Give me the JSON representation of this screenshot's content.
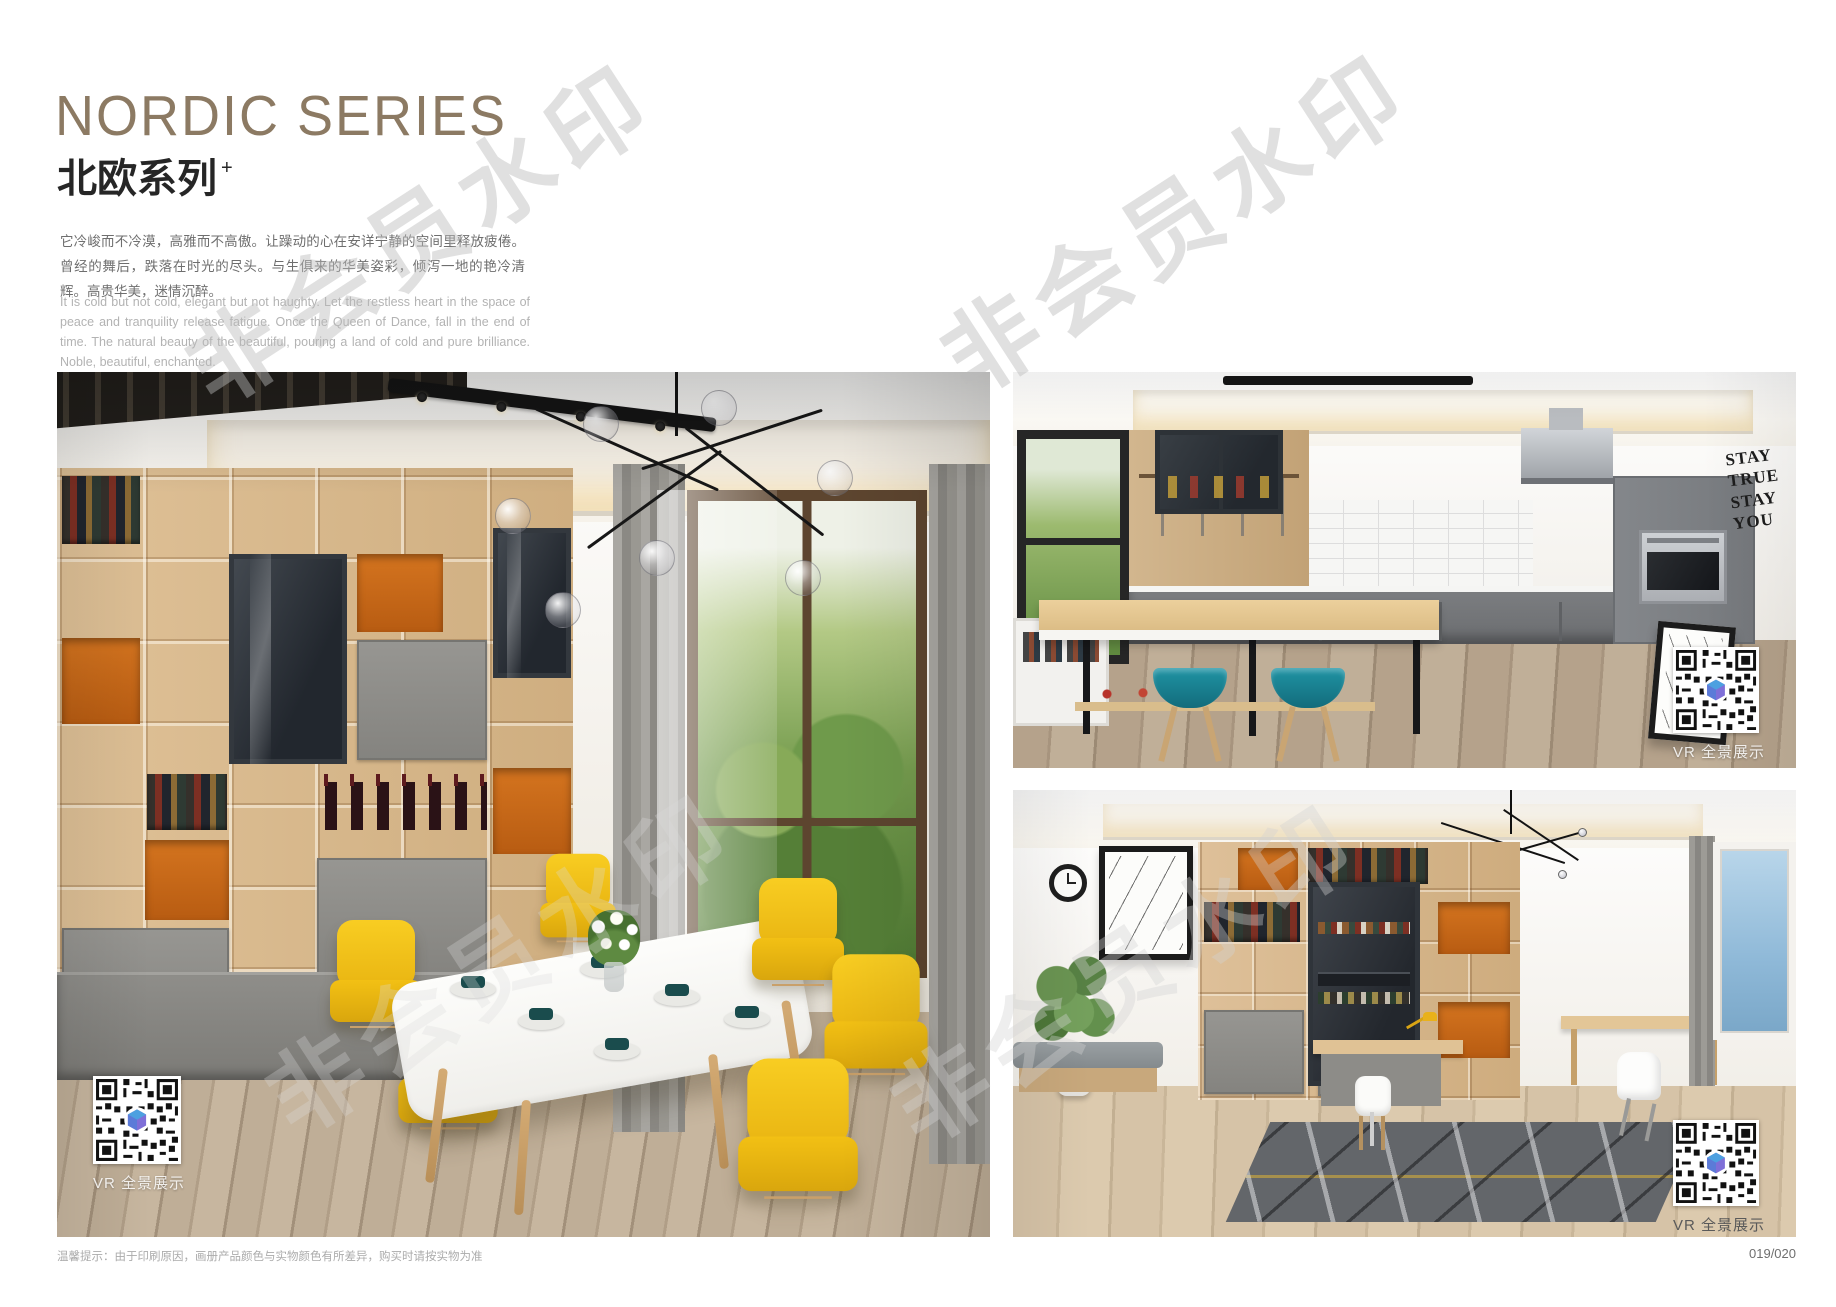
{
  "header": {
    "title_en": "NORDIC SERIES",
    "title_cn": "北欧系列",
    "title_superscript": "+",
    "paragraph_cn": "它冷峻而不冷漠，高雅而不高傲。让躁动的心在安详宁静的空间里释放疲倦。曾经的舞后，跌落在时光的尽头。与生俱来的华美姿彩，倾泻一地的艳冷清辉。高贵华美，迷情沉醉。",
    "paragraph_en": "It is cold but not cold, elegant but not haughty. Let the restless heart in the space of peace and tranquility release fatigue. Once the Queen of Dance, fall in the end of time. The natural beauty of the beautiful, pouring a land of cold and pure brilliance. Noble, beautiful, enchanted."
  },
  "photos": {
    "vr_label": "VR 全景展示",
    "main": {
      "subject": "dining-room-with-yellow-chairs-and-wood-shelving"
    },
    "kitchen": {
      "subject": "kitchen-with-bar-counter-and-teal-stools",
      "wall_art": [
        "STAY",
        "TRUE",
        "STAY",
        "YOU"
      ]
    },
    "study": {
      "subject": "study-room-with-desk-and-shelving"
    }
  },
  "watermark": {
    "text": "非会员水印"
  },
  "footer": {
    "note": "温馨提示：由于印刷原因，画册产品颜色与实物颜色有所差异，购买时请按实物为准",
    "page_number": "019/020"
  },
  "icons": {
    "qr_code": "qr-code",
    "qr_center_logo": "3d-cube"
  },
  "colors": {
    "title_accent": "#8c7a63",
    "shelf_wood": "#d6b488",
    "niche_orange": "#c96a1c",
    "chair_yellow": "#f2c31d",
    "stool_teal": "#177e90",
    "cabinet_grey": "#84878b"
  }
}
